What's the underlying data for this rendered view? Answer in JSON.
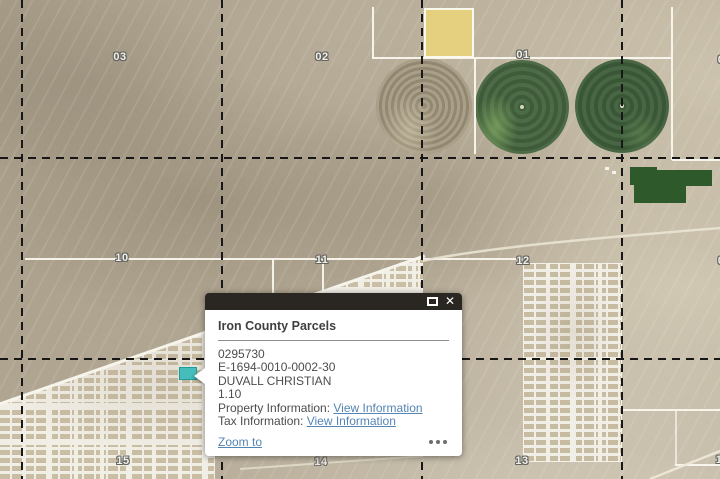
{
  "map": {
    "section_labels": [
      {
        "text": "03"
      },
      {
        "text": "02"
      },
      {
        "text": "01"
      },
      {
        "text": "0"
      },
      {
        "text": "10"
      },
      {
        "text": "11"
      },
      {
        "text": "12"
      },
      {
        "text": "0"
      },
      {
        "text": "15"
      },
      {
        "text": "14"
      },
      {
        "text": "13"
      },
      {
        "text": "1"
      }
    ],
    "selected_parcel_color": "#45bdbd"
  },
  "popup": {
    "title": "Iron County Parcels",
    "close_glyph": "✕",
    "fields": [
      "0295730",
      "E-1694-0010-0002-30",
      "DUVALL CHRISTIAN",
      "1.10"
    ],
    "info_rows": [
      {
        "label": "Property Information: ",
        "link": "View Information"
      },
      {
        "label": "Tax Information: ",
        "link": "View Information"
      }
    ],
    "footer": {
      "zoom_to": "Zoom to"
    },
    "colors": {
      "header_bg": "#2a2621",
      "link": "#5585b4",
      "body_text": "#4d4d4d"
    }
  }
}
